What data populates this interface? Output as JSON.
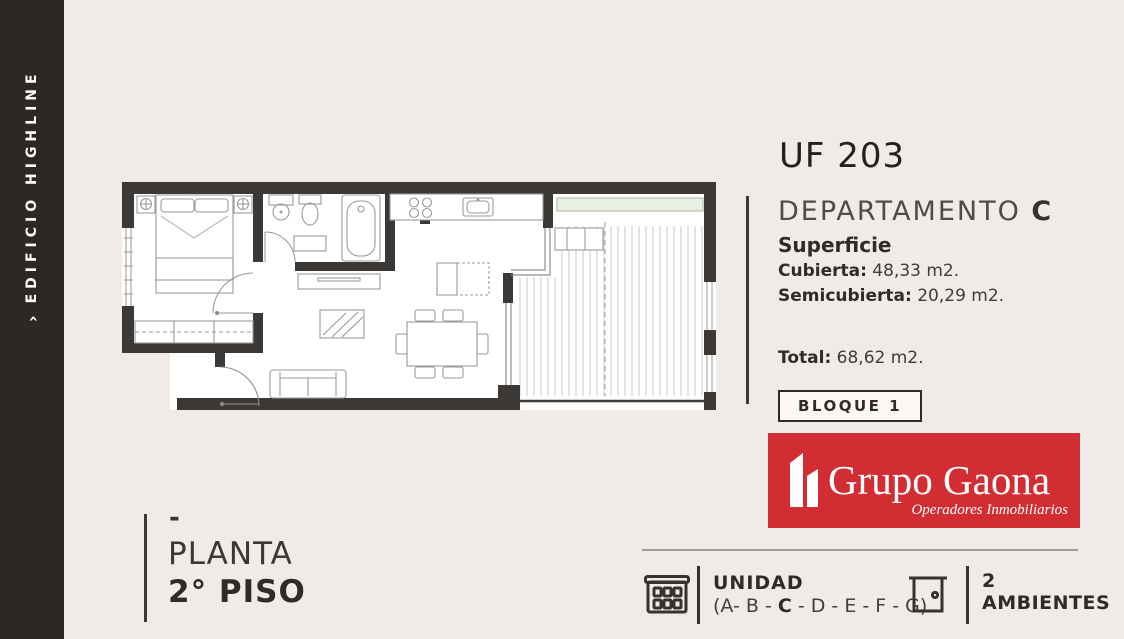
{
  "sidebar": {
    "arrow": "›",
    "building": "EDIFICIO HIGHLINE"
  },
  "unit": {
    "code": "UF 203",
    "type_label": "DEPARTAMENTO ",
    "type_letter": "C"
  },
  "surface": {
    "title": "Superficie",
    "rows": [
      {
        "label": "Cubierta:",
        "value": " 48,33 m2."
      },
      {
        "label": "Semicubierta:",
        "value": " 20,29 m2."
      }
    ],
    "total_label": "Total:",
    "total_value": " 68,62 m2."
  },
  "bloque": {
    "label": "BLOQUE 1"
  },
  "logo": {
    "name": "Grupo Gaona",
    "tagline": "Operadores Inmobiliarios"
  },
  "floor": {
    "dash": "-",
    "line1": "PLANTA",
    "line2": "2° PISO"
  },
  "footer": {
    "unidad": {
      "title": "UNIDAD",
      "prefix": "(A- B - ",
      "bold": "C",
      "suffix": " - D - E - F - G)"
    },
    "ambientes": {
      "count": "2",
      "label": "AMBIENTES"
    }
  },
  "colors": {
    "background": "#f1ebe7",
    "sidebar": "#2b2826",
    "wall": "#3b3836",
    "accent_red": "#d32d34",
    "planter_green": "#e9efe5",
    "text_dark": "#2e2b28"
  }
}
